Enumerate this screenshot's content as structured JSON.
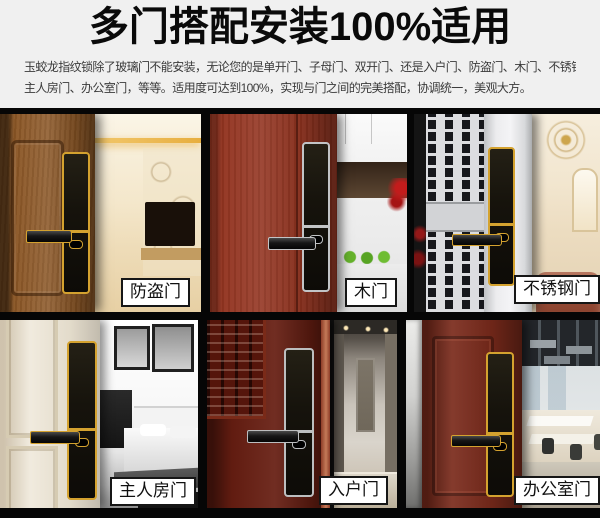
{
  "header": {
    "title": "多门搭配安装100%适用",
    "desc_line1": "玉蛟龙指纹锁除了玻璃门不能安装，无论您的是单开门、子母门、双开门、还是入户门、防盗门、木门、不锈钢门",
    "desc_line2": "主人房门、办公室门，等等。适用度可达到100%，实现与门之间的完美搭配，协调统一，美观大方。"
  },
  "tiles": [
    {
      "label": "防盗门",
      "door_color": "#8a5524",
      "trim_color": "#d4a22f"
    },
    {
      "label": "木门",
      "door_color": "#933420",
      "trim_color": "#c2c4c6"
    },
    {
      "label": "不锈钢门",
      "door_color": "#dcdde0",
      "trim_color": "#d4a22f"
    },
    {
      "label": "主人房门",
      "door_color": "#ece4d3",
      "trim_color": "#d4a22f"
    },
    {
      "label": "入户门",
      "door_color": "#661d11",
      "trim_color": "#bcbebf"
    },
    {
      "label": "办公室门",
      "door_color": "#7a2a1b",
      "trim_color": "#d4a22f"
    }
  ],
  "colors": {
    "header_bg": "#f0f0f0",
    "frame_black": "#060606",
    "title_color": "#0a0a0a",
    "label_bg": "#ffffff",
    "label_border": "#161616",
    "lock_body": "#16130c",
    "accent_gold": "#d4a22f",
    "accent_silver": "#c2c4c6"
  }
}
